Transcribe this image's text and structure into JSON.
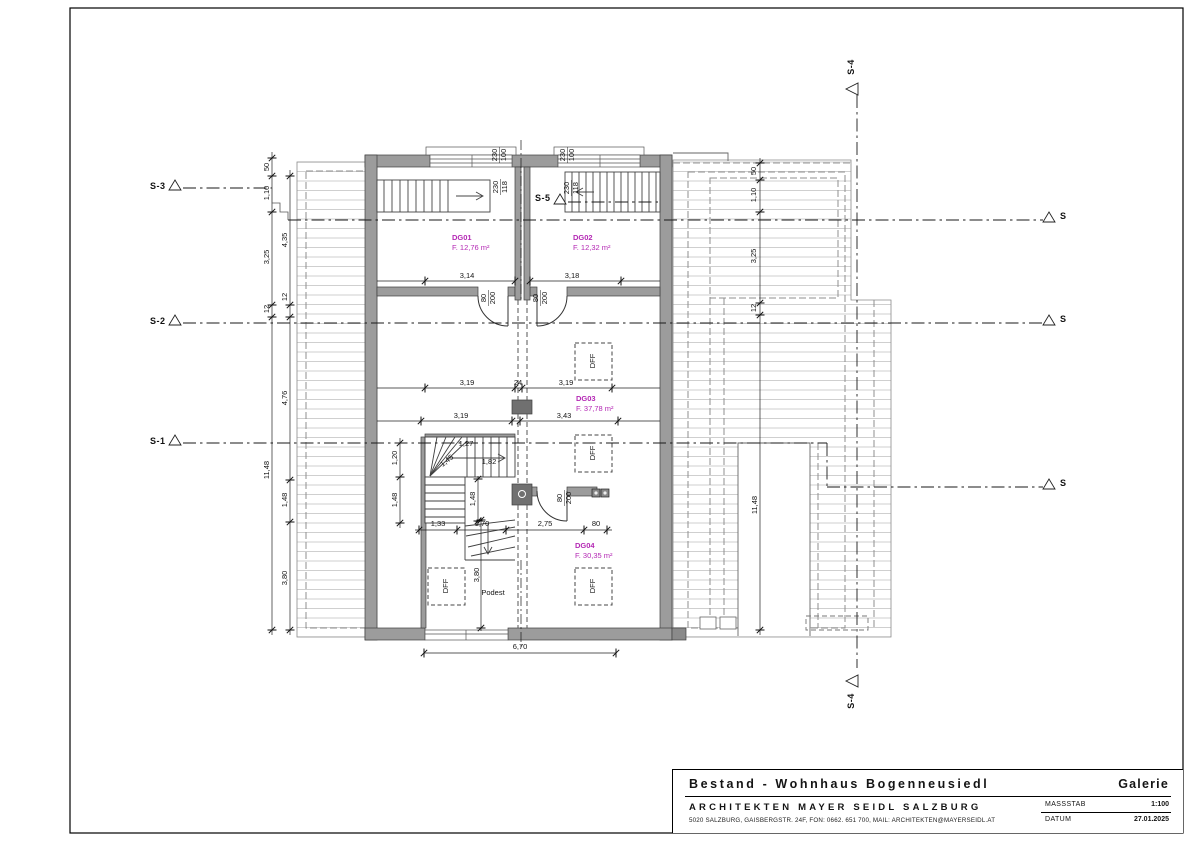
{
  "sheet": {
    "project": "Bestand - Wohnhaus Bogenneusiedl",
    "sheet_name": "Galerie",
    "firm": "ARCHITEKTEN MAYER SEIDL SALZBURG",
    "address": "5020 SALZBURG, GAISBERGSTR. 24F, FON: 0662. 651 700, MAIL: ARCHITEKTEN@MAYERSEIDL.AT",
    "massstab_label": "MASSSTAB",
    "massstab_value": "1:100",
    "datum_label": "DATUM",
    "datum_value": "27.01.2025"
  },
  "rooms": [
    {
      "id": "DG01",
      "area": "F. 12,76 m²"
    },
    {
      "id": "DG02",
      "area": "F. 12,32 m²"
    },
    {
      "id": "DG03",
      "area": "F. 37,78 m²"
    },
    {
      "id": "DG04",
      "area": "F. 30,35 m²"
    }
  ],
  "sections": {
    "s1": "S-1",
    "s2": "S-2",
    "s3": "S-3",
    "s4": "S-4",
    "s5": "S-5",
    "s_marker": "S"
  },
  "colors": {
    "wall_fill": "#9c9c9c",
    "wall_dark": "#707070",
    "hatch": "#cfcfcf",
    "room_label": "#b428b4"
  },
  "dimension_labels": [
    {
      "t": "230",
      "x": 495,
      "y": 155,
      "r": -90
    },
    {
      "t": "100",
      "x": 504,
      "y": 155,
      "r": -90
    },
    {
      "t": "230",
      "x": 496,
      "y": 187,
      "r": -90
    },
    {
      "t": "118",
      "x": 505,
      "y": 187,
      "r": -90
    },
    {
      "t": "230",
      "x": 563,
      "y": 155,
      "r": -90
    },
    {
      "t": "100",
      "x": 572,
      "y": 155,
      "r": -90
    },
    {
      "t": "230",
      "x": 567,
      "y": 188,
      "r": -90
    },
    {
      "t": "118",
      "x": 576,
      "y": 188,
      "r": -90
    },
    {
      "t": "80",
      "x": 484,
      "y": 298,
      "r": -90
    },
    {
      "t": "200",
      "x": 493,
      "y": 298,
      "r": -90
    },
    {
      "t": "80",
      "x": 536,
      "y": 298,
      "r": -90
    },
    {
      "t": "200",
      "x": 545,
      "y": 298,
      "r": -90
    },
    {
      "t": "3,14",
      "x": 467,
      "y": 276
    },
    {
      "t": "3,18",
      "x": 572,
      "y": 276
    },
    {
      "t": "3,19",
      "x": 467,
      "y": 383
    },
    {
      "t": "24",
      "x": 518,
      "y": 383
    },
    {
      "t": "3,19",
      "x": 566,
      "y": 383
    },
    {
      "t": "3,19",
      "x": 461,
      "y": 416
    },
    {
      "t": "3,43",
      "x": 564,
      "y": 416
    },
    {
      "t": "1,27",
      "x": 466,
      "y": 444
    },
    {
      "t": "1,45",
      "x": 447,
      "y": 461,
      "r": -38
    },
    {
      "t": "1,82",
      "x": 489,
      "y": 462
    },
    {
      "t": "1,20",
      "x": 395,
      "y": 458,
      "r": -90
    },
    {
      "t": "1,48",
      "x": 395,
      "y": 500,
      "r": -90
    },
    {
      "t": "1,48",
      "x": 473,
      "y": 499,
      "r": -90
    },
    {
      "t": "80",
      "x": 560,
      "y": 498,
      "r": -90
    },
    {
      "t": "200",
      "x": 569,
      "y": 498,
      "r": -90
    },
    {
      "t": "1,33",
      "x": 438,
      "y": 524
    },
    {
      "t": "1,70",
      "x": 482,
      "y": 524
    },
    {
      "t": "2,75",
      "x": 545,
      "y": 524
    },
    {
      "t": "80",
      "x": 596,
      "y": 524
    },
    {
      "t": "3,80",
      "x": 477,
      "y": 575,
      "r": -90
    },
    {
      "t": "Podest",
      "x": 493,
      "y": 593
    },
    {
      "t": "6,70",
      "x": 520,
      "y": 647
    },
    {
      "t": "50",
      "x": 267,
      "y": 167,
      "r": -90
    },
    {
      "t": "1,10",
      "x": 267,
      "y": 193,
      "r": -90
    },
    {
      "t": "3,25",
      "x": 267,
      "y": 257,
      "r": -90
    },
    {
      "t": "12",
      "x": 267,
      "y": 309,
      "r": -90
    },
    {
      "t": "11,48",
      "x": 267,
      "y": 470,
      "r": -90
    },
    {
      "t": "4,35",
      "x": 285,
      "y": 240,
      "r": -90
    },
    {
      "t": "12",
      "x": 285,
      "y": 297,
      "r": -90
    },
    {
      "t": "4,76",
      "x": 285,
      "y": 398,
      "r": -90
    },
    {
      "t": "1,48",
      "x": 285,
      "y": 500,
      "r": -90
    },
    {
      "t": "3,80",
      "x": 285,
      "y": 578,
      "r": -90
    },
    {
      "t": "50",
      "x": 754,
      "y": 171,
      "r": -90
    },
    {
      "t": "1,10",
      "x": 754,
      "y": 195,
      "r": -90
    },
    {
      "t": "3,25",
      "x": 754,
      "y": 256,
      "r": -90
    },
    {
      "t": "12",
      "x": 754,
      "y": 308,
      "r": -90
    },
    {
      "t": "11,48",
      "x": 755,
      "y": 505,
      "r": -90
    },
    {
      "t": "DFF",
      "x": 593,
      "y": 361,
      "r": -90
    },
    {
      "t": "DFF",
      "x": 593,
      "y": 453,
      "r": -90
    },
    {
      "t": "DFF",
      "x": 593,
      "y": 586,
      "r": -90
    },
    {
      "t": "DFF",
      "x": 446,
      "y": 586,
      "r": -90
    }
  ]
}
